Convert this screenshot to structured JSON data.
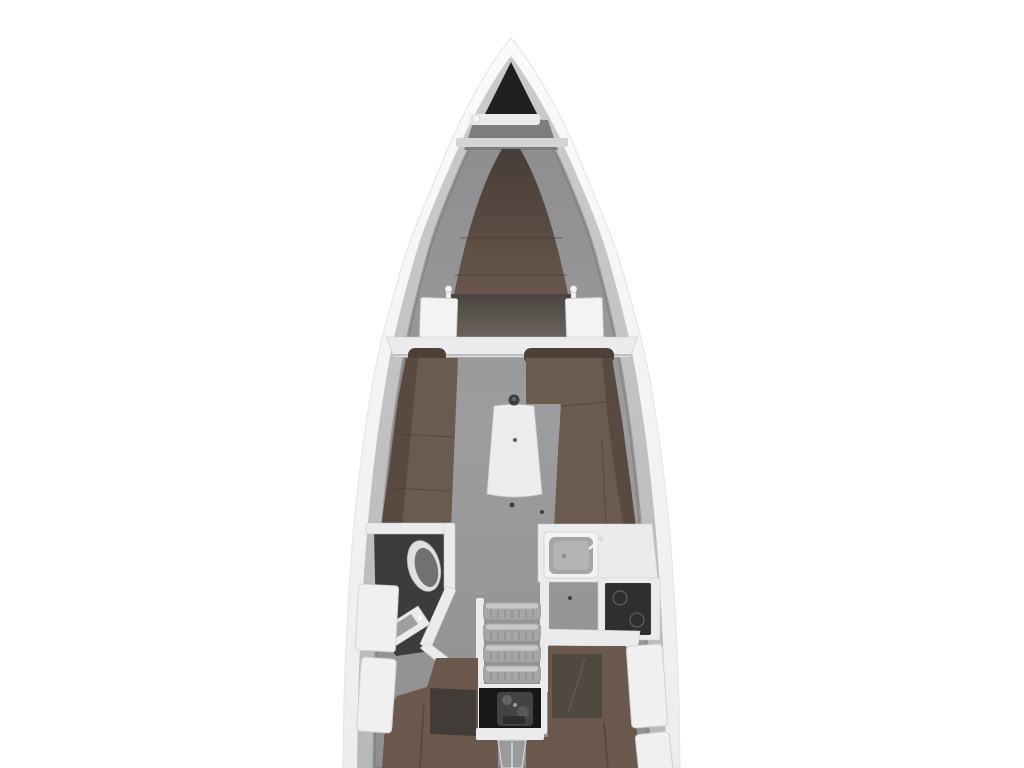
{
  "scene": {
    "label": "sailing-yacht-interior-floor-plan",
    "view": "top-down",
    "parts": [
      "hull",
      "anchor-locker",
      "windlass",
      "v-berth",
      "forward-bulkhead",
      "saloon-port-settee",
      "saloon-starboard-settee",
      "saloon-table",
      "head-compartment",
      "toilet",
      "head-sink",
      "galley",
      "galley-sink",
      "stove",
      "companionway-steps",
      "engine-compartment",
      "aft-cabin-port-berth",
      "aft-cabin-starboard-berth",
      "side-lockers"
    ]
  },
  "colors": {
    "background": "#ffffff",
    "hull_outer_top": "#fafafb",
    "hull_outer_bottom": "#ededef",
    "hull_band_top": "#cbcbcd",
    "hull_band_bottom": "#b8b8ba",
    "interior_top": "#8a8a8d",
    "interior_mid": "#9d9da0",
    "interior_bottom": "#909093",
    "interior_shadow": "#747478",
    "anchor_locker": "#1f1f21",
    "bow_shelf": "#7d7d80",
    "white_trim": "#ebebed",
    "bright_white": "#f3f3f4",
    "trim_edge": "#c9c9cb",
    "vberth_top": "#473c36",
    "vberth_bottom": "#6d5a50",
    "cushion": "#6b5a4e",
    "cushion_dark": "#584a41",
    "backrest": "#4c4138",
    "seam": "#463b33",
    "table": "#ededef",
    "walkway_top": "#4a4540",
    "walkway_bottom": "#6e6660",
    "head_floor": "#3c3c3f",
    "toilet_rim": "#e0e0e2",
    "toilet_bowl": "#717174",
    "sink_basin": "#a5a5a7",
    "sink_basin_light": "#b4b4b6",
    "stove": "#2f2f31",
    "stove_mark": "#606063",
    "steps": "#a6a6a8",
    "steps_light": "#c8c8ca",
    "steps_tick": "#8a8a8c",
    "engine_bg": "#171719",
    "engine_part": "#434346",
    "engine_part2": "#656568",
    "berth": "#6c594e",
    "berth_panel": "#50493f",
    "berth_panel_port": "#423c38",
    "locker": "#f0f0f1",
    "locker_edge": "#d2d2d4",
    "floor_strip": "#9a9a9c",
    "dot_dark": "#3e3e40",
    "pin_white": "#f2f2f3"
  }
}
